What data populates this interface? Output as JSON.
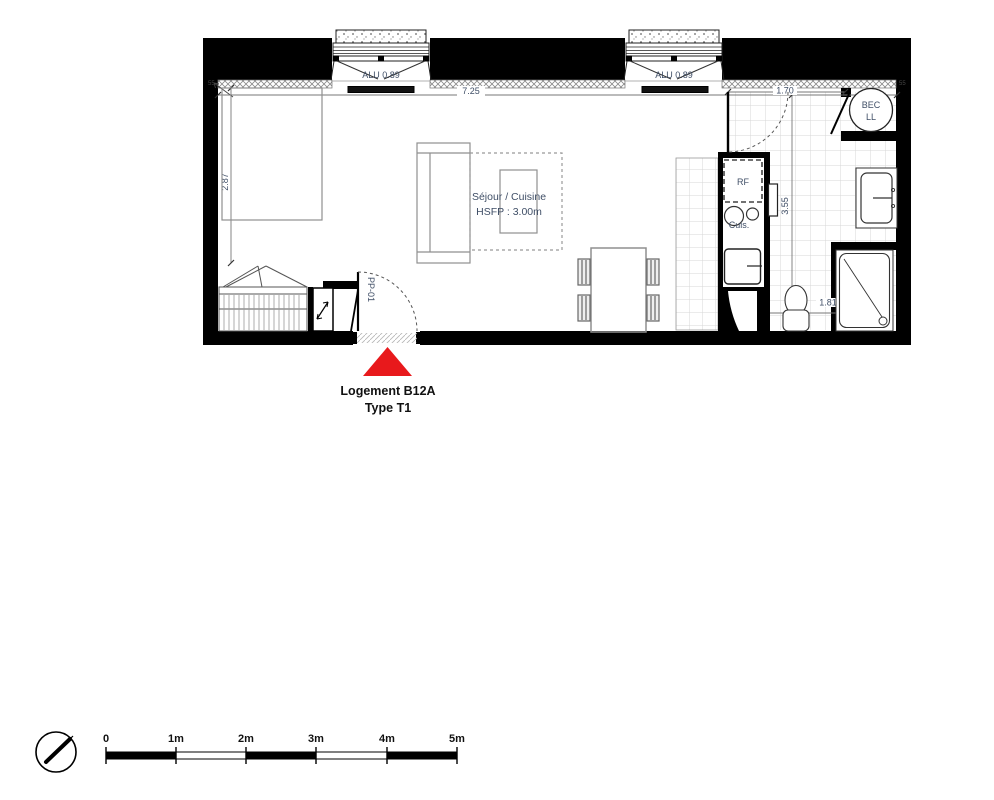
{
  "title": {
    "line1": "Logement B12A",
    "line2": "Type T1"
  },
  "room_labels": {
    "sejour": "Séjour / Cuisine",
    "hsfp": "HSFP : 3.00m"
  },
  "fixtures": {
    "fridge": "RF",
    "cooktop": "Cuis.",
    "heater_line1": "BEC",
    "heater_line2": "LL"
  },
  "doors": {
    "entrance": "PP-01"
  },
  "windows": {
    "left": "ALU 0.89",
    "right": "ALU 0.89"
  },
  "dimensions": {
    "living_width": "7.25",
    "living_height": "2.87",
    "bath_width": "1.70",
    "bath_depth": "3.55",
    "shower_width": "1.81",
    "insulation_left": "55",
    "insulation_right": "55"
  },
  "scale_bar": {
    "labels": [
      "0",
      "1m",
      "2m",
      "3m",
      "4m",
      "5m"
    ]
  },
  "colors": {
    "marker": "#e8191c",
    "annotation": "#3f4e66",
    "wall": "#000000"
  }
}
